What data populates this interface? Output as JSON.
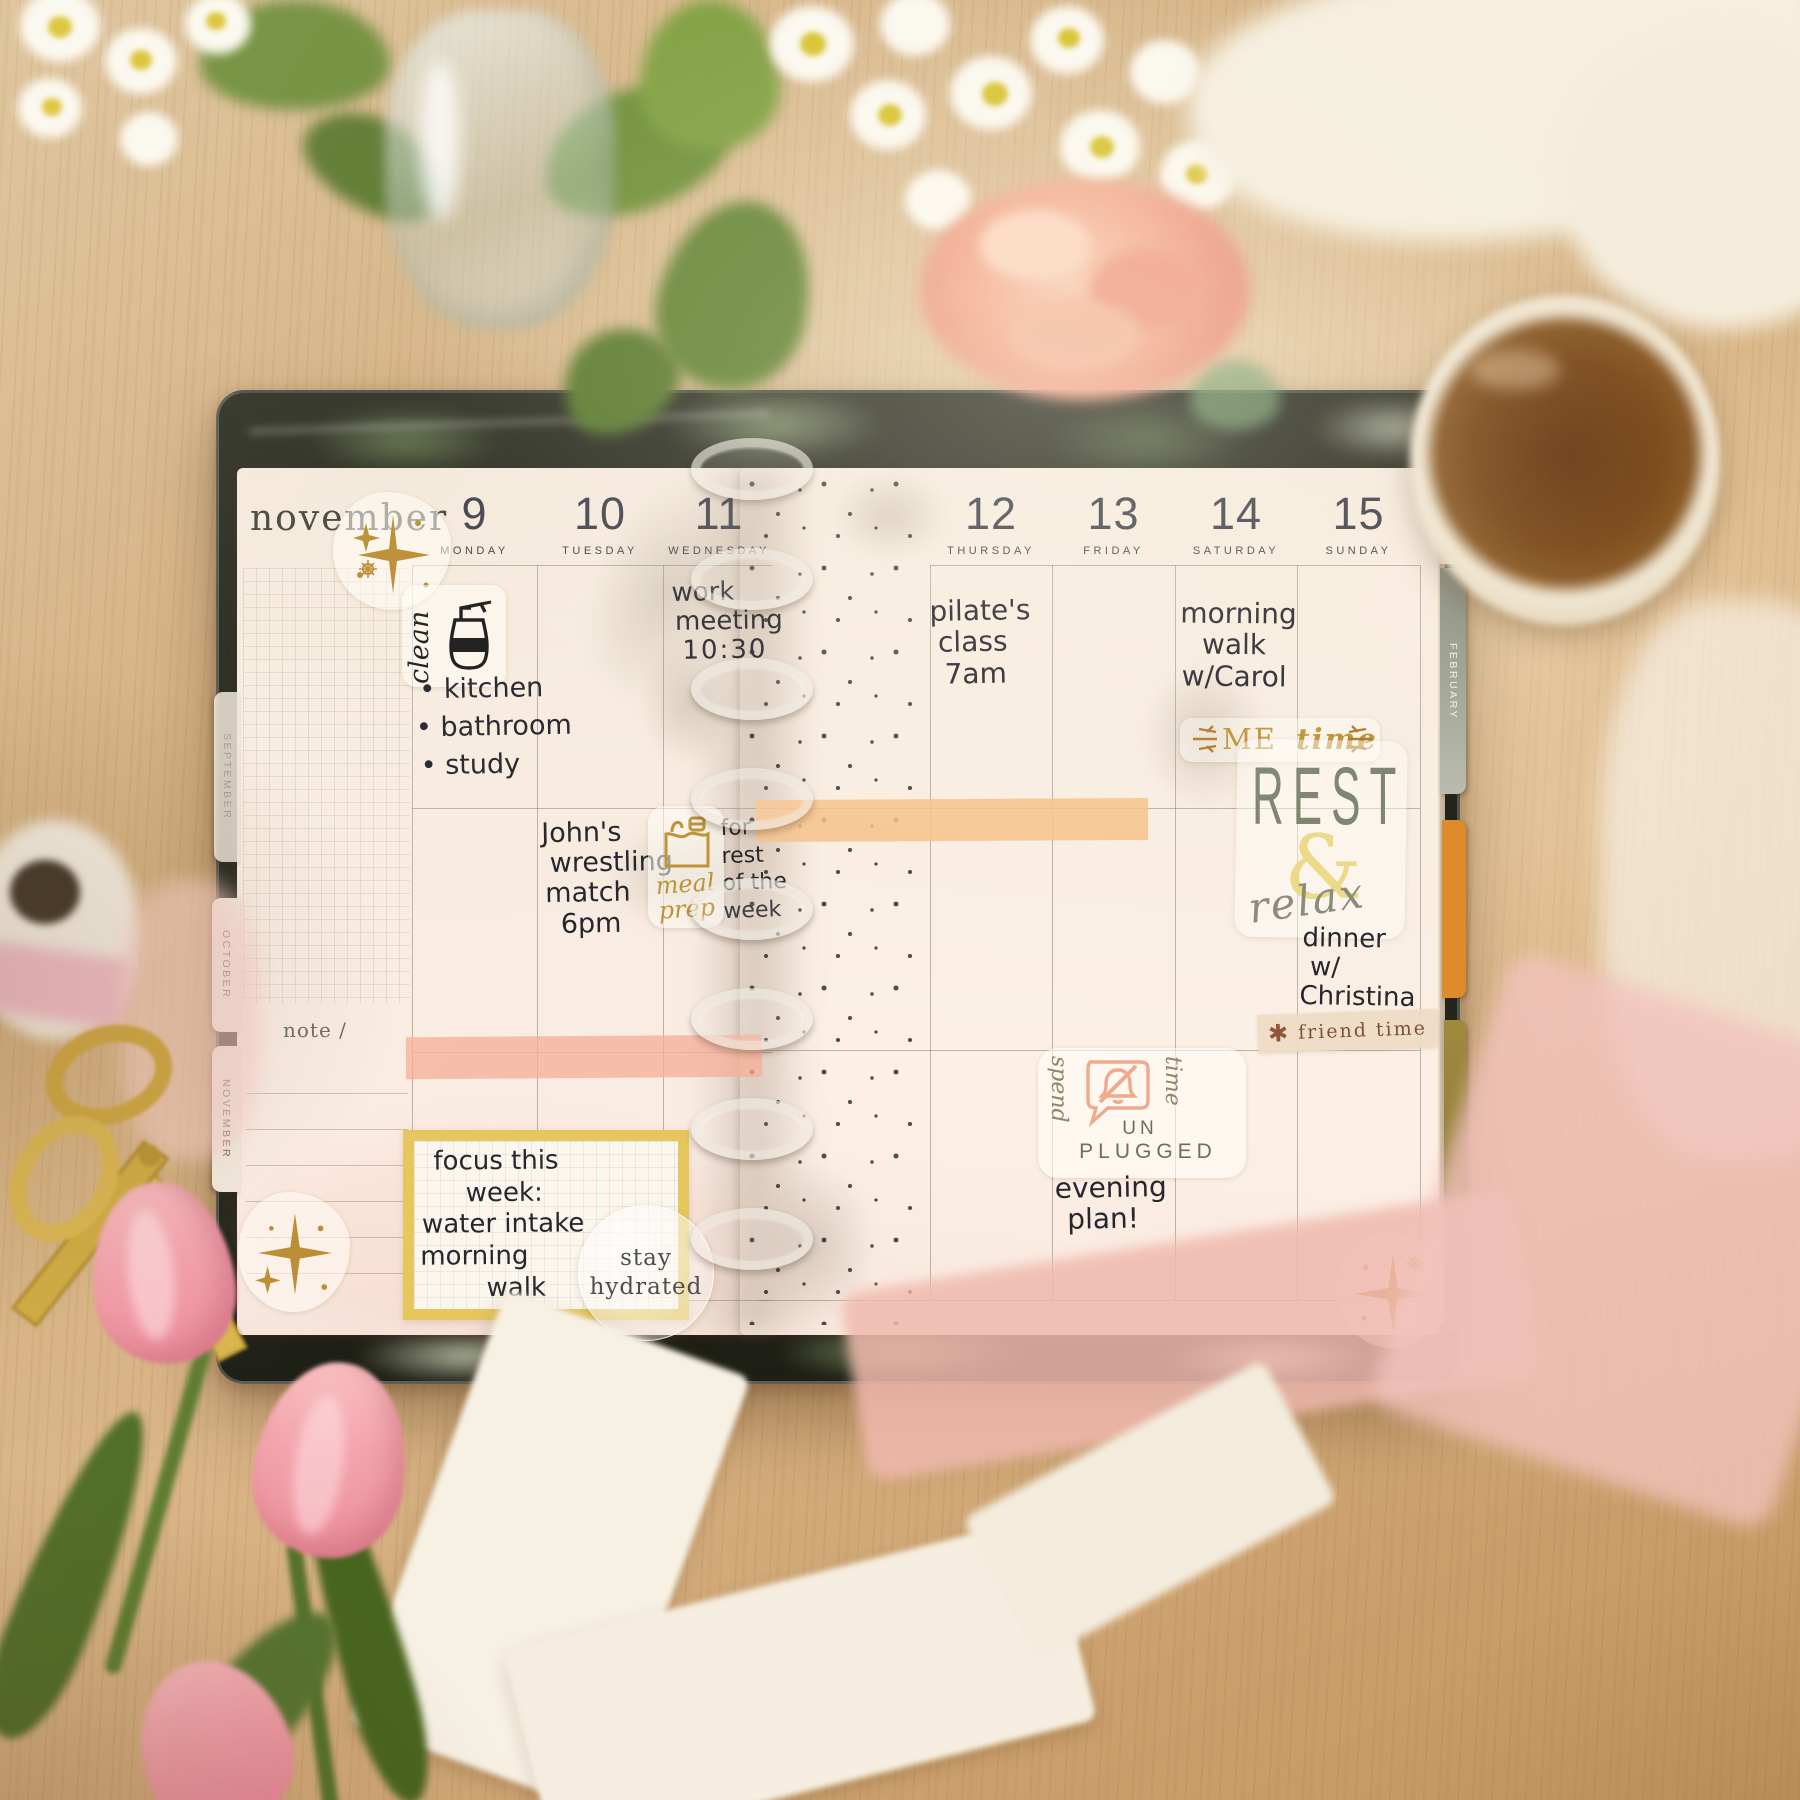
{
  "colors": {
    "highlight_left": "#f5b09a",
    "highlight_right": "#f7c28b",
    "gold_sticker": "#bf9336",
    "focus_box_border": "#e6c75e"
  },
  "planner": {
    "month_label": "november",
    "note_label": "note /",
    "left_days": [
      {
        "num": "9",
        "name": "MONDAY"
      },
      {
        "num": "10",
        "name": "TUESDAY"
      },
      {
        "num": "11",
        "name": "WEDNESDAY"
      }
    ],
    "right_days": [
      {
        "num": "12",
        "name": "THURSDAY"
      },
      {
        "num": "13",
        "name": "FRIDAY"
      },
      {
        "num": "14",
        "name": "SATURDAY"
      },
      {
        "num": "15",
        "name": "SUNDAY"
      }
    ],
    "tabs_left": [
      {
        "label": "SEPTEMBER"
      },
      {
        "label": "OCTOBER"
      },
      {
        "label": "NOVEMBER"
      }
    ],
    "tabs_right": [
      {
        "label": "JANUARY"
      },
      {
        "label": "FEBRUARY"
      }
    ],
    "entries": {
      "clean": {
        "sticker_label": "clean",
        "items": [
          "kitchen",
          "bathroom",
          "study"
        ]
      },
      "work_meeting": {
        "lines": [
          "work",
          "meeting",
          "10:30"
        ]
      },
      "wrestling": {
        "lines": [
          "John's",
          "wrestling",
          "match",
          "6pm"
        ]
      },
      "meal_prep": {
        "sticker_lines": [
          "meal",
          "prep"
        ],
        "note_lines": [
          "for",
          "rest",
          "of the",
          "week"
        ]
      },
      "focus_box": {
        "lines": [
          "focus this",
          "week:",
          "water intake",
          "morning",
          "walk"
        ]
      },
      "stay_hydrated": {
        "lines": [
          "stay",
          "hydrated"
        ]
      },
      "pilates": {
        "lines": [
          "pilate's",
          "class",
          "7am"
        ]
      },
      "morning_walk": {
        "lines": [
          "morning",
          "walk",
          "w/Carol"
        ]
      },
      "me_time": {
        "word1": "ME",
        "word2": "time"
      },
      "rest_relax": {
        "rest": "REST",
        "amp": "&",
        "relax": "relax"
      },
      "dinner": {
        "lines": [
          "dinner",
          "w/",
          "Christina"
        ]
      },
      "friend_time": {
        "asterisk": "✱",
        "label": "friend time"
      },
      "unplugged": {
        "spend": "spend",
        "time": "time",
        "un": "UN",
        "plugged": "PLUGGED"
      },
      "evening": {
        "lines": [
          "evening",
          "plan!"
        ]
      }
    }
  }
}
